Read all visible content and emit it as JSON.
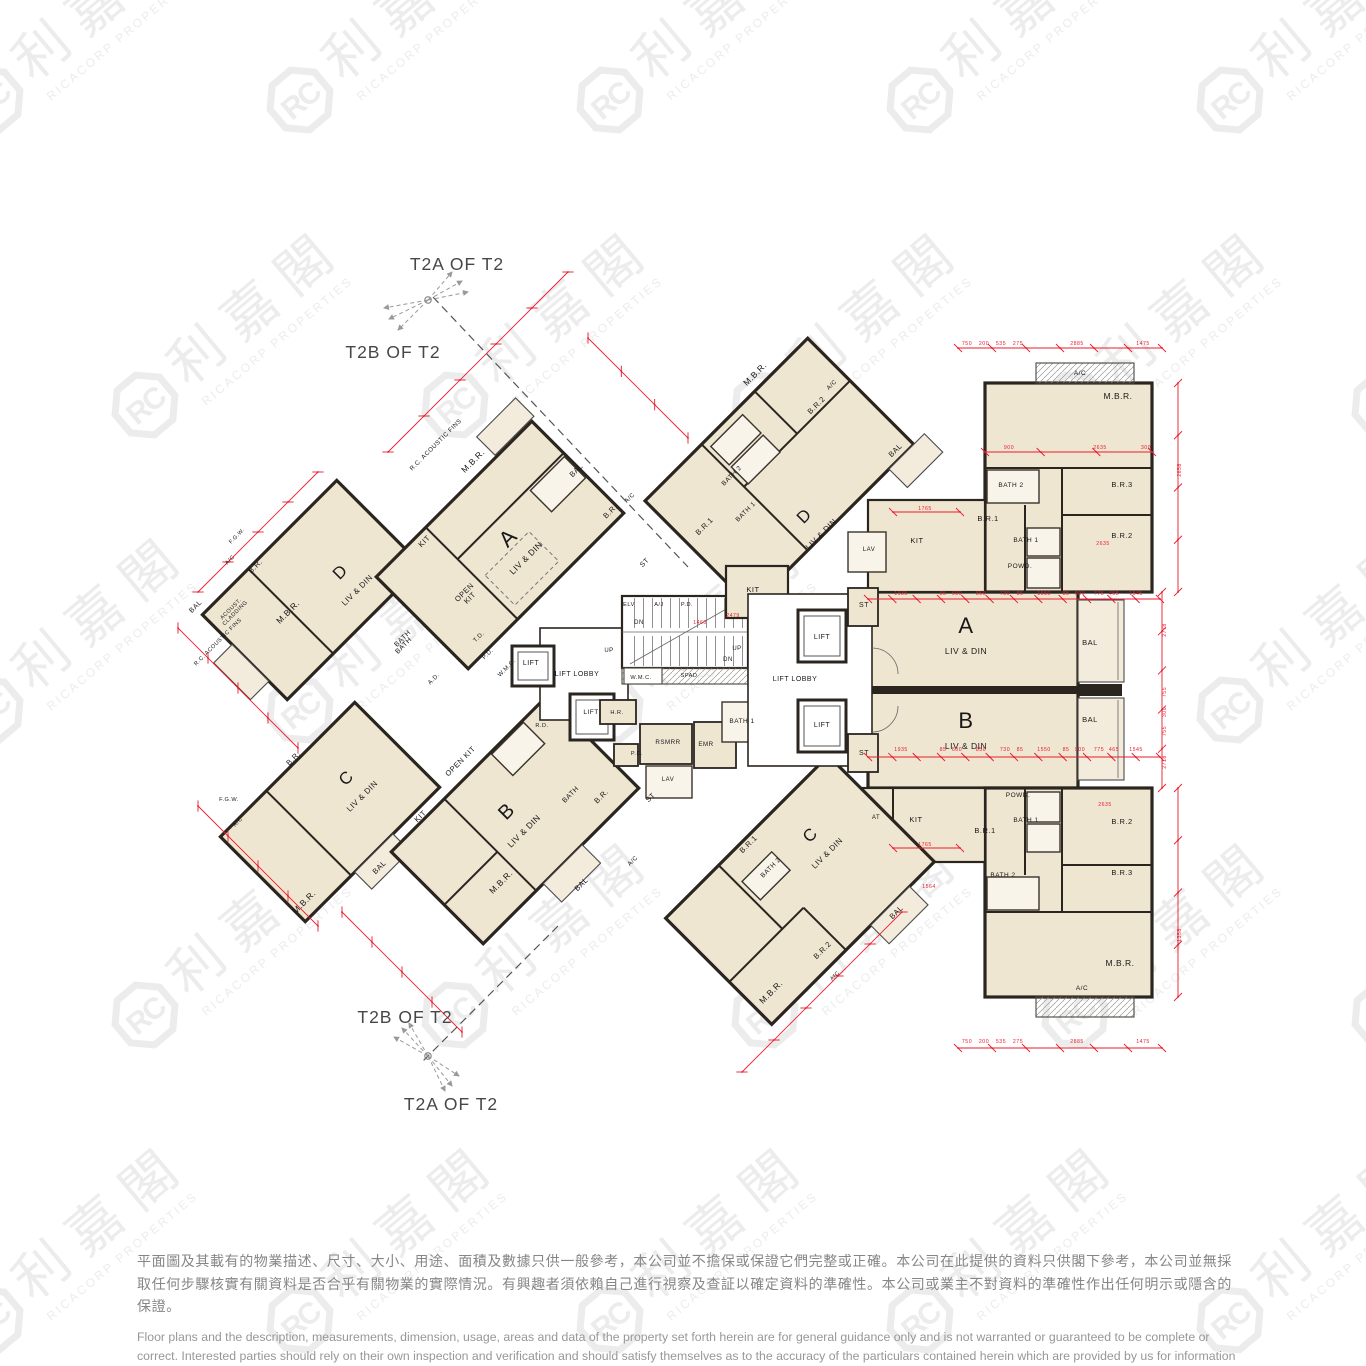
{
  "annotations": {
    "top_a": "T2A OF  T2",
    "top_b": "T2B OF T2",
    "bottom_b": "T2B OF T2",
    "bottom_a": "T2A OF  T2"
  },
  "watermark": {
    "monogram": "RC",
    "cjk": "利嘉閣",
    "latin": "RICACORP PROPERTIES",
    "color": "#ececec"
  },
  "plan": {
    "colors": {
      "wall": "#2b2520",
      "room": "#efe6d2",
      "bath": "#f8f4ea",
      "balcony": "#f3ecdc",
      "dim": "#e81c2e",
      "label": "#181818"
    },
    "labels": [
      [
        "A",
        513,
        543,
        -45,
        22
      ],
      [
        "LIV & DIN",
        528,
        560,
        -45,
        8.5
      ],
      [
        "M.B.R.",
        475,
        463,
        -45,
        8.5
      ],
      [
        "BAL",
        578,
        472,
        -45,
        7.5
      ],
      [
        "B.R.",
        612,
        513,
        -45,
        7.5
      ],
      [
        "A/C",
        631,
        499,
        -45,
        6
      ],
      [
        "KIT",
        426,
        543,
        -45,
        7.5
      ],
      [
        "OPEN|KIT",
        466,
        594,
        -45,
        7.5
      ],
      [
        "BATH",
        405,
        647,
        -45,
        7
      ],
      [
        "ST",
        646,
        564,
        -45,
        7
      ],
      [
        "LIFT",
        531,
        665,
        0,
        7
      ],
      [
        "P.D.",
        489,
        655,
        -45,
        6
      ],
      [
        "W.M.C.",
        508,
        669,
        -45,
        6
      ],
      [
        "T.D.",
        480,
        638,
        -45,
        6
      ],
      [
        "R.C. ACOUSTIC FINS",
        437,
        446,
        -45,
        6.2
      ],
      [
        "D",
        344,
        576,
        -45,
        17
      ],
      [
        "LIV & DIN",
        359,
        592,
        -45,
        8
      ],
      [
        "B.R.",
        257,
        568,
        -45,
        7.5
      ],
      [
        "M.B.R.",
        290,
        614,
        -45,
        8.5
      ],
      [
        "BAL",
        197,
        608,
        -45,
        7
      ],
      [
        "BATH",
        404,
        640,
        -45,
        7
      ],
      [
        "A.D.",
        435,
        680,
        -45,
        6
      ],
      [
        "ACOUST.|CLADDING",
        232,
        610,
        -45,
        5.6
      ],
      [
        "R.C. ACOUSTIC FINS",
        219,
        643,
        -45,
        5.6
      ],
      [
        "F.G.W.",
        238,
        537,
        -45,
        5.6
      ],
      [
        "A/C",
        231,
        561,
        -45,
        5.6
      ],
      [
        "C",
        350,
        782,
        -45,
        17
      ],
      [
        "LIV & DIN",
        364,
        798,
        -45,
        8
      ],
      [
        "B.R.",
        295,
        760,
        -45,
        7.5
      ],
      [
        "M.B.R.",
        306,
        904,
        -45,
        8.5
      ],
      [
        "BAL",
        381,
        869,
        -45,
        7.5
      ],
      [
        "KIT",
        422,
        818,
        -45,
        7.5
      ],
      [
        "F.G.W.",
        229,
        801,
        0,
        5.6
      ],
      [
        "A/C",
        239,
        823,
        -45,
        5.6
      ],
      [
        "B",
        511,
        816,
        -45,
        20
      ],
      [
        "LIV & DIN",
        526,
        833,
        -45,
        8.5
      ],
      [
        "OPEN KIT",
        462,
        763,
        -45,
        7.5
      ],
      [
        "M.B.R.",
        503,
        884,
        -45,
        8.5
      ],
      [
        "BAL",
        583,
        886,
        -45,
        7.5
      ],
      [
        "BATH",
        572,
        796,
        -45,
        7
      ],
      [
        "B.R.",
        603,
        798,
        -45,
        7.5
      ],
      [
        "ST",
        652,
        799,
        -45,
        7
      ],
      [
        "A/C",
        634,
        862,
        -45,
        6
      ],
      [
        "LIFT LOBBY",
        577,
        676,
        0,
        7
      ],
      [
        "LIFT",
        591,
        714,
        0,
        6.5
      ],
      [
        "ELV",
        629,
        606,
        0,
        5.6
      ],
      [
        "A/J",
        659,
        606,
        0,
        5.6
      ],
      [
        "P.D.",
        687,
        606,
        0,
        5.6
      ],
      [
        "UP",
        609,
        652,
        0,
        6
      ],
      [
        "DN",
        639,
        624,
        0,
        6
      ],
      [
        "UP",
        737,
        650,
        0,
        6
      ],
      [
        "DN",
        728,
        661,
        0,
        6
      ],
      [
        "W.M.C.",
        641,
        679,
        0,
        5.6
      ],
      [
        "SPAD",
        689,
        677,
        0,
        5.6
      ],
      [
        "H.R.",
        617,
        714,
        0,
        5.6
      ],
      [
        "RSMRR",
        668,
        744,
        0,
        6.2
      ],
      [
        "EMR",
        706,
        746,
        0,
        6.2
      ],
      [
        "BATH 1",
        742,
        723,
        0,
        6.5
      ],
      [
        "LAV",
        668,
        781,
        0,
        6
      ],
      [
        "P.D.",
        637,
        755,
        0,
        5.6
      ],
      [
        "R.D.",
        542,
        727,
        0,
        5.6
      ],
      [
        "LIFT LOBBY",
        795,
        681,
        0,
        7
      ],
      [
        "LIFT",
        822,
        639,
        0,
        7
      ],
      [
        "LIFT",
        822,
        727,
        0,
        7
      ],
      [
        "ST",
        864,
        607,
        0,
        7
      ],
      [
        "ST",
        864,
        755,
        0,
        7
      ],
      [
        "D",
        808,
        520,
        -45,
        17
      ],
      [
        "LIV & DIN",
        823,
        536,
        -45,
        8
      ],
      [
        "M.B.R.",
        757,
        376,
        -45,
        8.5
      ],
      [
        "B.R.2",
        818,
        407,
        -45,
        7.5
      ],
      [
        "A/C",
        833,
        386,
        -45,
        6
      ],
      [
        "BAL",
        897,
        452,
        -45,
        7.5
      ],
      [
        "BATH 2",
        733,
        477,
        -45,
        6.5
      ],
      [
        "BATH 1",
        747,
        513,
        -45,
        6.5
      ],
      [
        "B.R.1",
        706,
        528,
        -45,
        7.5
      ],
      [
        "KIT",
        753,
        592,
        0,
        7.5
      ],
      [
        "A",
        966,
        633,
        0,
        22
      ],
      [
        "LIV & DIN",
        966,
        654,
        0,
        8.5
      ],
      [
        "KIT",
        917,
        543,
        0,
        7.5
      ],
      [
        "B.R.1",
        988,
        521,
        0,
        7.5
      ],
      [
        "BATH 1",
        1026,
        542,
        0,
        6.5
      ],
      [
        "POWD.",
        1020,
        568,
        0,
        6.5
      ],
      [
        "LAV",
        869,
        551,
        0,
        6
      ],
      [
        "BATH 2",
        1011,
        487,
        0,
        6.5
      ],
      [
        "M.B.R.",
        1118,
        399,
        0,
        8.5
      ],
      [
        "B.R.3",
        1122,
        487,
        0,
        7.5
      ],
      [
        "B.R.2",
        1122,
        538,
        0,
        7.5
      ],
      [
        "A/C",
        1080,
        375,
        0,
        6.5
      ],
      [
        "BAL",
        1090,
        645,
        0,
        7.5
      ],
      [
        "B",
        966,
        728,
        0,
        22
      ],
      [
        "LIV & DIN",
        966,
        749,
        0,
        8.5
      ],
      [
        "POWD.",
        1018,
        797,
        0,
        6.5
      ],
      [
        "BATH 1",
        1026,
        822,
        0,
        6.5
      ],
      [
        "B.R.1",
        985,
        833,
        0,
        7.5
      ],
      [
        "BATH 2",
        1003,
        877,
        0,
        6.5
      ],
      [
        "B.R.2",
        1122,
        824,
        0,
        7.5
      ],
      [
        "B.R.3",
        1122,
        875,
        0,
        7.5
      ],
      [
        "M.B.R.",
        1120,
        966,
        0,
        8.5
      ],
      [
        "A/C",
        1082,
        990,
        0,
        6.5
      ],
      [
        "BAL",
        1090,
        722,
        0,
        7.5
      ],
      [
        "KIT",
        916,
        822,
        0,
        7.5
      ],
      [
        "AT",
        876,
        819,
        0,
        6
      ],
      [
        "C",
        814,
        839,
        -45,
        17
      ],
      [
        "LIV & DIN",
        829,
        855,
        -45,
        8
      ],
      [
        "B.R.1",
        750,
        846,
        -45,
        7.5
      ],
      [
        "BATH 2",
        772,
        869,
        -45,
        6.5
      ],
      [
        "B.R.2",
        824,
        952,
        -45,
        7.5
      ],
      [
        "M.B.R.",
        773,
        994,
        -45,
        8.5
      ],
      [
        "BAL",
        898,
        914,
        -45,
        7.5
      ],
      [
        "A/C",
        836,
        977,
        -45,
        5.6
      ]
    ],
    "dim_labels": [
      [
        "1935",
        901,
        595,
        0
      ],
      [
        "85",
        943,
        595,
        0
      ],
      [
        "600",
        957,
        595,
        0
      ],
      [
        "850",
        981,
        595,
        0
      ],
      [
        "730",
        1005,
        595,
        0
      ],
      [
        "85",
        1020,
        595,
        0
      ],
      [
        "1550",
        1044,
        595,
        0
      ],
      [
        "85",
        1066,
        595,
        0
      ],
      [
        "900",
        1080,
        595,
        0
      ],
      [
        "775",
        1099,
        595,
        0
      ],
      [
        "465",
        1114,
        595,
        0
      ],
      [
        "1545",
        1136,
        595,
        0
      ],
      [
        "1935",
        901,
        751,
        0
      ],
      [
        "85",
        943,
        751,
        0
      ],
      [
        "600",
        957,
        751,
        0
      ],
      [
        "850",
        981,
        751,
        0
      ],
      [
        "730",
        1005,
        751,
        0
      ],
      [
        "85",
        1020,
        751,
        0
      ],
      [
        "1550",
        1044,
        751,
        0
      ],
      [
        "85",
        1066,
        751,
        0
      ],
      [
        "900",
        1080,
        751,
        0
      ],
      [
        "775",
        1099,
        751,
        0
      ],
      [
        "465",
        1114,
        751,
        0
      ],
      [
        "1545",
        1136,
        751,
        0
      ],
      [
        "2778",
        1166,
        630,
        -90
      ],
      [
        "755",
        1166,
        692,
        -90
      ],
      [
        "300",
        1166,
        712,
        -90
      ],
      [
        "755",
        1166,
        731,
        -90
      ],
      [
        "2718",
        1166,
        762,
        -90
      ],
      [
        "750",
        967,
        1043,
        0
      ],
      [
        "200",
        984,
        1043,
        0
      ],
      [
        "535",
        1001,
        1043,
        0
      ],
      [
        "275",
        1018,
        1043,
        0
      ],
      [
        "2885",
        1077,
        1043,
        0
      ],
      [
        "1475",
        1143,
        1043,
        0
      ],
      [
        "750",
        967,
        345,
        0
      ],
      [
        "200",
        984,
        345,
        0
      ],
      [
        "535",
        1001,
        345,
        0
      ],
      [
        "275",
        1018,
        345,
        0
      ],
      [
        "2885",
        1077,
        345,
        0
      ],
      [
        "1475",
        1143,
        345,
        0
      ],
      [
        "900",
        1009,
        449,
        0
      ],
      [
        "2635",
        1100,
        449,
        0
      ],
      [
        "300",
        1146,
        449,
        0
      ],
      [
        "2635",
        1103,
        545,
        0
      ],
      [
        "2635",
        1105,
        806,
        0
      ],
      [
        "1765",
        925,
        510,
        0
      ],
      [
        "1765",
        925,
        846,
        0
      ],
      [
        "1564",
        929,
        888,
        0
      ],
      [
        "2479",
        733,
        617,
        0
      ],
      [
        "1460",
        700,
        624,
        0
      ],
      [
        "2658",
        1181,
        470,
        -90
      ],
      [
        "1358",
        1181,
        935,
        -90
      ]
    ],
    "dim_chains": [
      [
        868,
        599,
        1160,
        599,
        13
      ],
      [
        868,
        757,
        1160,
        757,
        13
      ],
      [
        1162,
        592,
        1162,
        788,
        6
      ],
      [
        958,
        1048,
        1162,
        1048,
        7
      ],
      [
        958,
        348,
        1162,
        348,
        7
      ],
      [
        985,
        452,
        1152,
        452,
        4
      ],
      [
        1178,
        383,
        1178,
        592,
        5
      ],
      [
        1178,
        788,
        1178,
        997,
        5
      ],
      [
        893,
        512,
        960,
        512,
        2
      ],
      [
        893,
        848,
        960,
        848,
        2
      ],
      [
        388,
        452,
        568,
        272,
        6
      ],
      [
        198,
        592,
        318,
        472,
        5
      ],
      [
        178,
        628,
        298,
        748,
        5
      ],
      [
        198,
        806,
        318,
        926,
        5
      ],
      [
        342,
        912,
        462,
        1032,
        5
      ],
      [
        588,
        338,
        688,
        438,
        4
      ],
      [
        742,
        1072,
        902,
        912,
        6
      ]
    ]
  },
  "disclaimer": {
    "zh": "平面圖及其載有的物業描述、尺寸、大小、用途、面積及數據只供一般參考，本公司並不擔保或保證它們完整或正確。本公司在此提供的資料只供閣下參考，本公司並無採取任何步驟核實有關資料是否合乎有關物業的實際情況。有興趣者須依賴自己進行視察及查証以確定資料的準確性。本公司或業主不對資料的準確性作出任何明示或隱含的保證。",
    "en": "Floor plans and the description, measurements, dimension, usage, areas and data of the property set forth herein are for general guidance only and is not warranted or guaranteed to be complete or correct.  Interested parties should rely on their own inspection and verification and should satisfy themselves as to the accuracy of the particulars contained herein which are provided by us for information only.  Our Company has not taken any step to verify whether the information reflects the actual status of the property.  No warranty for accuracy is given or implied by the owners or us."
  }
}
